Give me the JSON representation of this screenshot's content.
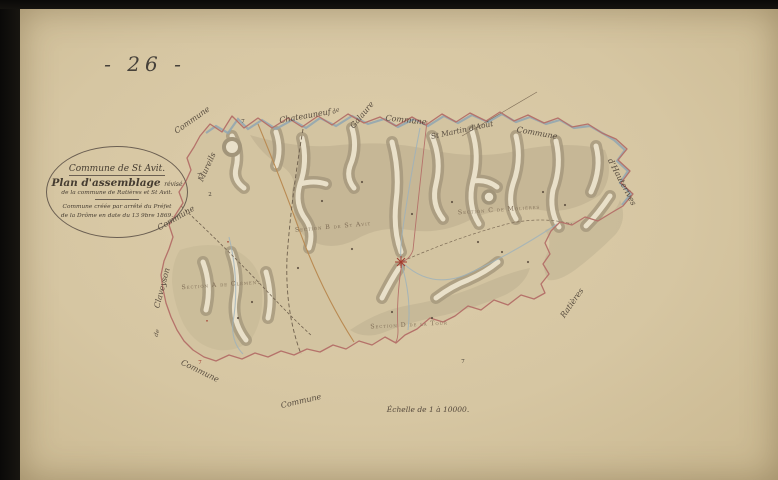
{
  "document": {
    "plate_number": "- 26 -",
    "cartouche": {
      "title": "Commune de St Avit.",
      "subtitle_main": "Plan d'assemblage",
      "subtitle_note": "révisé",
      "line3": "de la commune de Ratières et St Avit.",
      "line4": "Commune créée par arrêté du Préfet",
      "line5": "de la Drôme en date du 13 9bre 1869."
    },
    "scale_note": "Échelle de 1 à 10000."
  },
  "map": {
    "section_labels": [
      {
        "text": "Section A de Clément",
        "x": 221,
        "y": 285,
        "rot": -4
      },
      {
        "text": "Section B de St Avit",
        "x": 333,
        "y": 227,
        "rot": -5
      },
      {
        "text": "Section C de Molières",
        "x": 499,
        "y": 210,
        "rot": -4
      },
      {
        "text": "Section D de la Tour",
        "x": 409,
        "y": 325,
        "rot": -3
      }
    ],
    "edge_labels": [
      {
        "text": "Commune",
        "x": 192,
        "y": 120,
        "rot": -35
      },
      {
        "text": "Mureils",
        "x": 207,
        "y": 167,
        "rot": -65
      },
      {
        "text": "Commune",
        "x": 176,
        "y": 218,
        "rot": -30
      },
      {
        "text": "Chateauneuf",
        "x": 305,
        "y": 116,
        "rot": -10
      },
      {
        "text": "de",
        "x": 336,
        "y": 111,
        "rot": -25,
        "size": 6
      },
      {
        "text": "Galaure",
        "x": 362,
        "y": 115,
        "rot": -50
      },
      {
        "text": "Commune",
        "x": 406,
        "y": 120,
        "rot": 6
      },
      {
        "text": "St Martin d'Août",
        "x": 462,
        "y": 130,
        "rot": -12,
        "size": 7.5
      },
      {
        "text": "Commune",
        "x": 537,
        "y": 133,
        "rot": 10
      },
      {
        "text": "d'Hauterives",
        "x": 622,
        "y": 182,
        "rot": 62
      },
      {
        "text": "Ratières",
        "x": 572,
        "y": 303,
        "rot": -55
      },
      {
        "text": "Claveyson",
        "x": 162,
        "y": 288,
        "rot": -75
      },
      {
        "text": "de",
        "x": 157,
        "y": 333,
        "rot": -75,
        "size": 6
      },
      {
        "text": "Commune",
        "x": 200,
        "y": 371,
        "rot": 26
      },
      {
        "text": "Commune",
        "x": 301,
        "y": 401,
        "rot": -13
      }
    ],
    "marks": [
      {
        "text": "7",
        "x": 243,
        "y": 122,
        "color": "#4a4338"
      },
      {
        "text": "7",
        "x": 199,
        "y": 176,
        "color": "#4a4338"
      },
      {
        "text": "2",
        "x": 210,
        "y": 195,
        "color": "#4a4338"
      },
      {
        "text": "7",
        "x": 463,
        "y": 362,
        "color": "#4a4338"
      },
      {
        "text": "7",
        "x": 200,
        "y": 363,
        "color": "#a33b2e"
      },
      {
        "text": "•",
        "x": 228,
        "y": 243,
        "color": "#a33b2e"
      },
      {
        "text": "•",
        "x": 207,
        "y": 322,
        "color": "#a33b2e"
      }
    ]
  },
  "colors": {
    "paper": "#d6c6a2",
    "ink": "#46413a",
    "commune_boundary": "#b5726a",
    "water": "#8fa6b2",
    "terrain_shade": "#a2957a",
    "valley_floor": "#e9e0c9",
    "road": "#b98a52",
    "accent_red": "#a33b2e"
  }
}
